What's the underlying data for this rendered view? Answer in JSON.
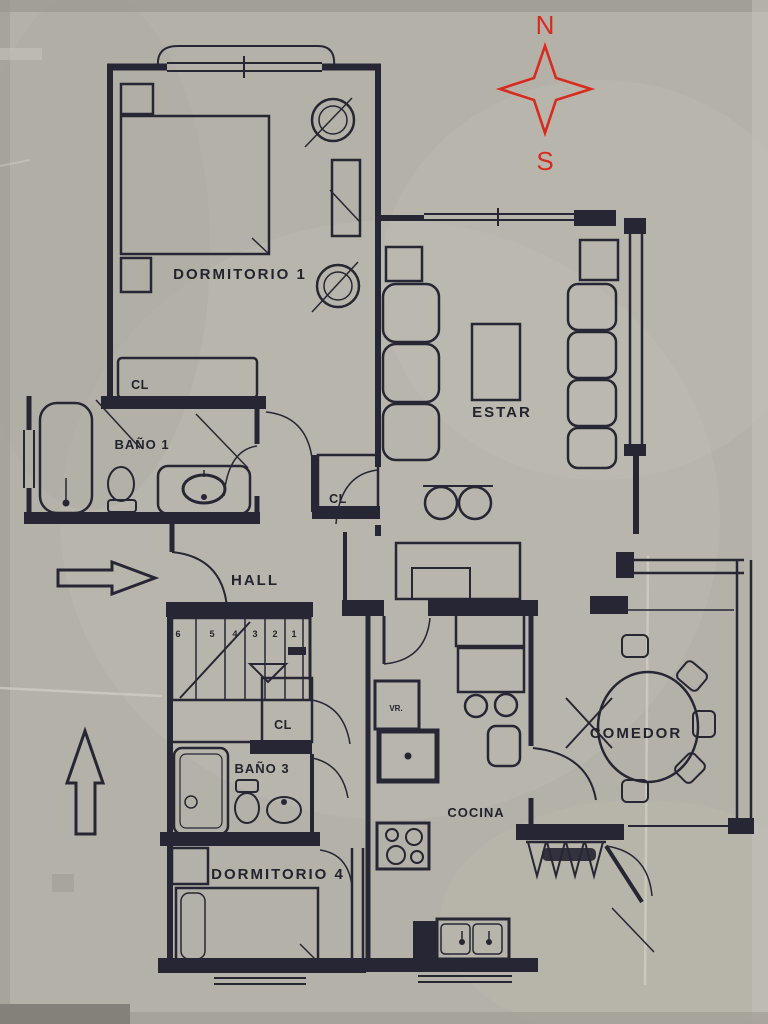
{
  "document": {
    "type": "scanned-apartment-floor-plan",
    "paper_color": "#b4b1a8",
    "ink_color": "#262634",
    "compass_color": "#d92a1e"
  },
  "compass": {
    "north": "N",
    "south": "S"
  },
  "labels": {
    "dormitorio1": "DORMITORIO 1",
    "estar": "ESTAR",
    "bano1": "BAÑO 1",
    "cl_dormitorio1": "CL",
    "cl_hall": "CL",
    "hall": "HALL",
    "cl_corridor": "CL",
    "bano3": "BAÑO 3",
    "dormitorio4": "DORMITORIO 4",
    "cocina": "COCINA",
    "comedor": "COMEDOR",
    "appliance": "VR."
  },
  "stairs": {
    "steps": [
      "6",
      "5",
      "4",
      "3",
      "2",
      "1"
    ]
  }
}
